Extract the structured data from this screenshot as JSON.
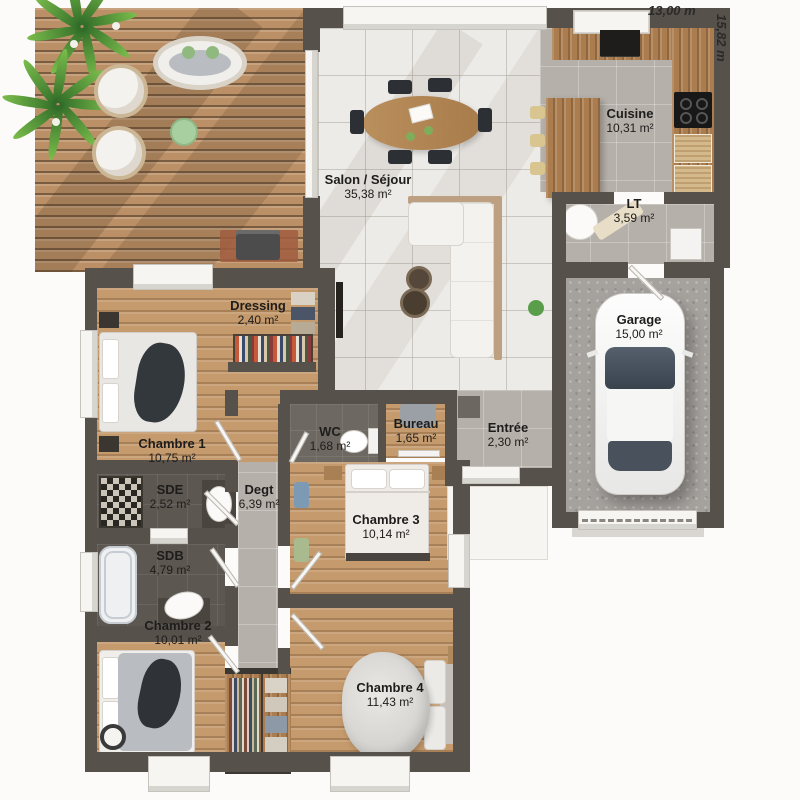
{
  "dimensions": {
    "width_label": "13,00 m",
    "height_label": "15,82 m"
  },
  "rooms": [
    {
      "name": "Salon / Séjour",
      "area": "35,38 m²"
    },
    {
      "name": "Cuisine",
      "area": "10,31 m²"
    },
    {
      "name": "LT",
      "area": "3,59 m²"
    },
    {
      "name": "Garage",
      "area": "15,00 m²"
    },
    {
      "name": "Dressing",
      "area": "2,40 m²"
    },
    {
      "name": "Chambre 1",
      "area": "10,75 m²"
    },
    {
      "name": "WC",
      "area": "1,68 m²"
    },
    {
      "name": "Bureau",
      "area": "1,65 m²"
    },
    {
      "name": "Entrée",
      "area": "2,30 m²"
    },
    {
      "name": "SDE",
      "area": "2,52 m²"
    },
    {
      "name": "Degt",
      "area": "6,39 m²"
    },
    {
      "name": "SDB",
      "area": "4,79 m²"
    },
    {
      "name": "Chambre 2",
      "area": "10,01 m²"
    },
    {
      "name": "Chambre 3",
      "area": "10,14 m²"
    },
    {
      "name": "Chambre 4",
      "area": "11,43 m²"
    }
  ],
  "palette": {
    "wall": "#57514b",
    "deck_wood": "#bb9066",
    "bedroom_wood": "#c59a6c",
    "tile_light": "#edebe7",
    "tile_grey": "#b6b0aa",
    "bath_dark": "#5c5751",
    "garage_floor": "#a5a19d",
    "plant_green": "#7cbd4c"
  }
}
